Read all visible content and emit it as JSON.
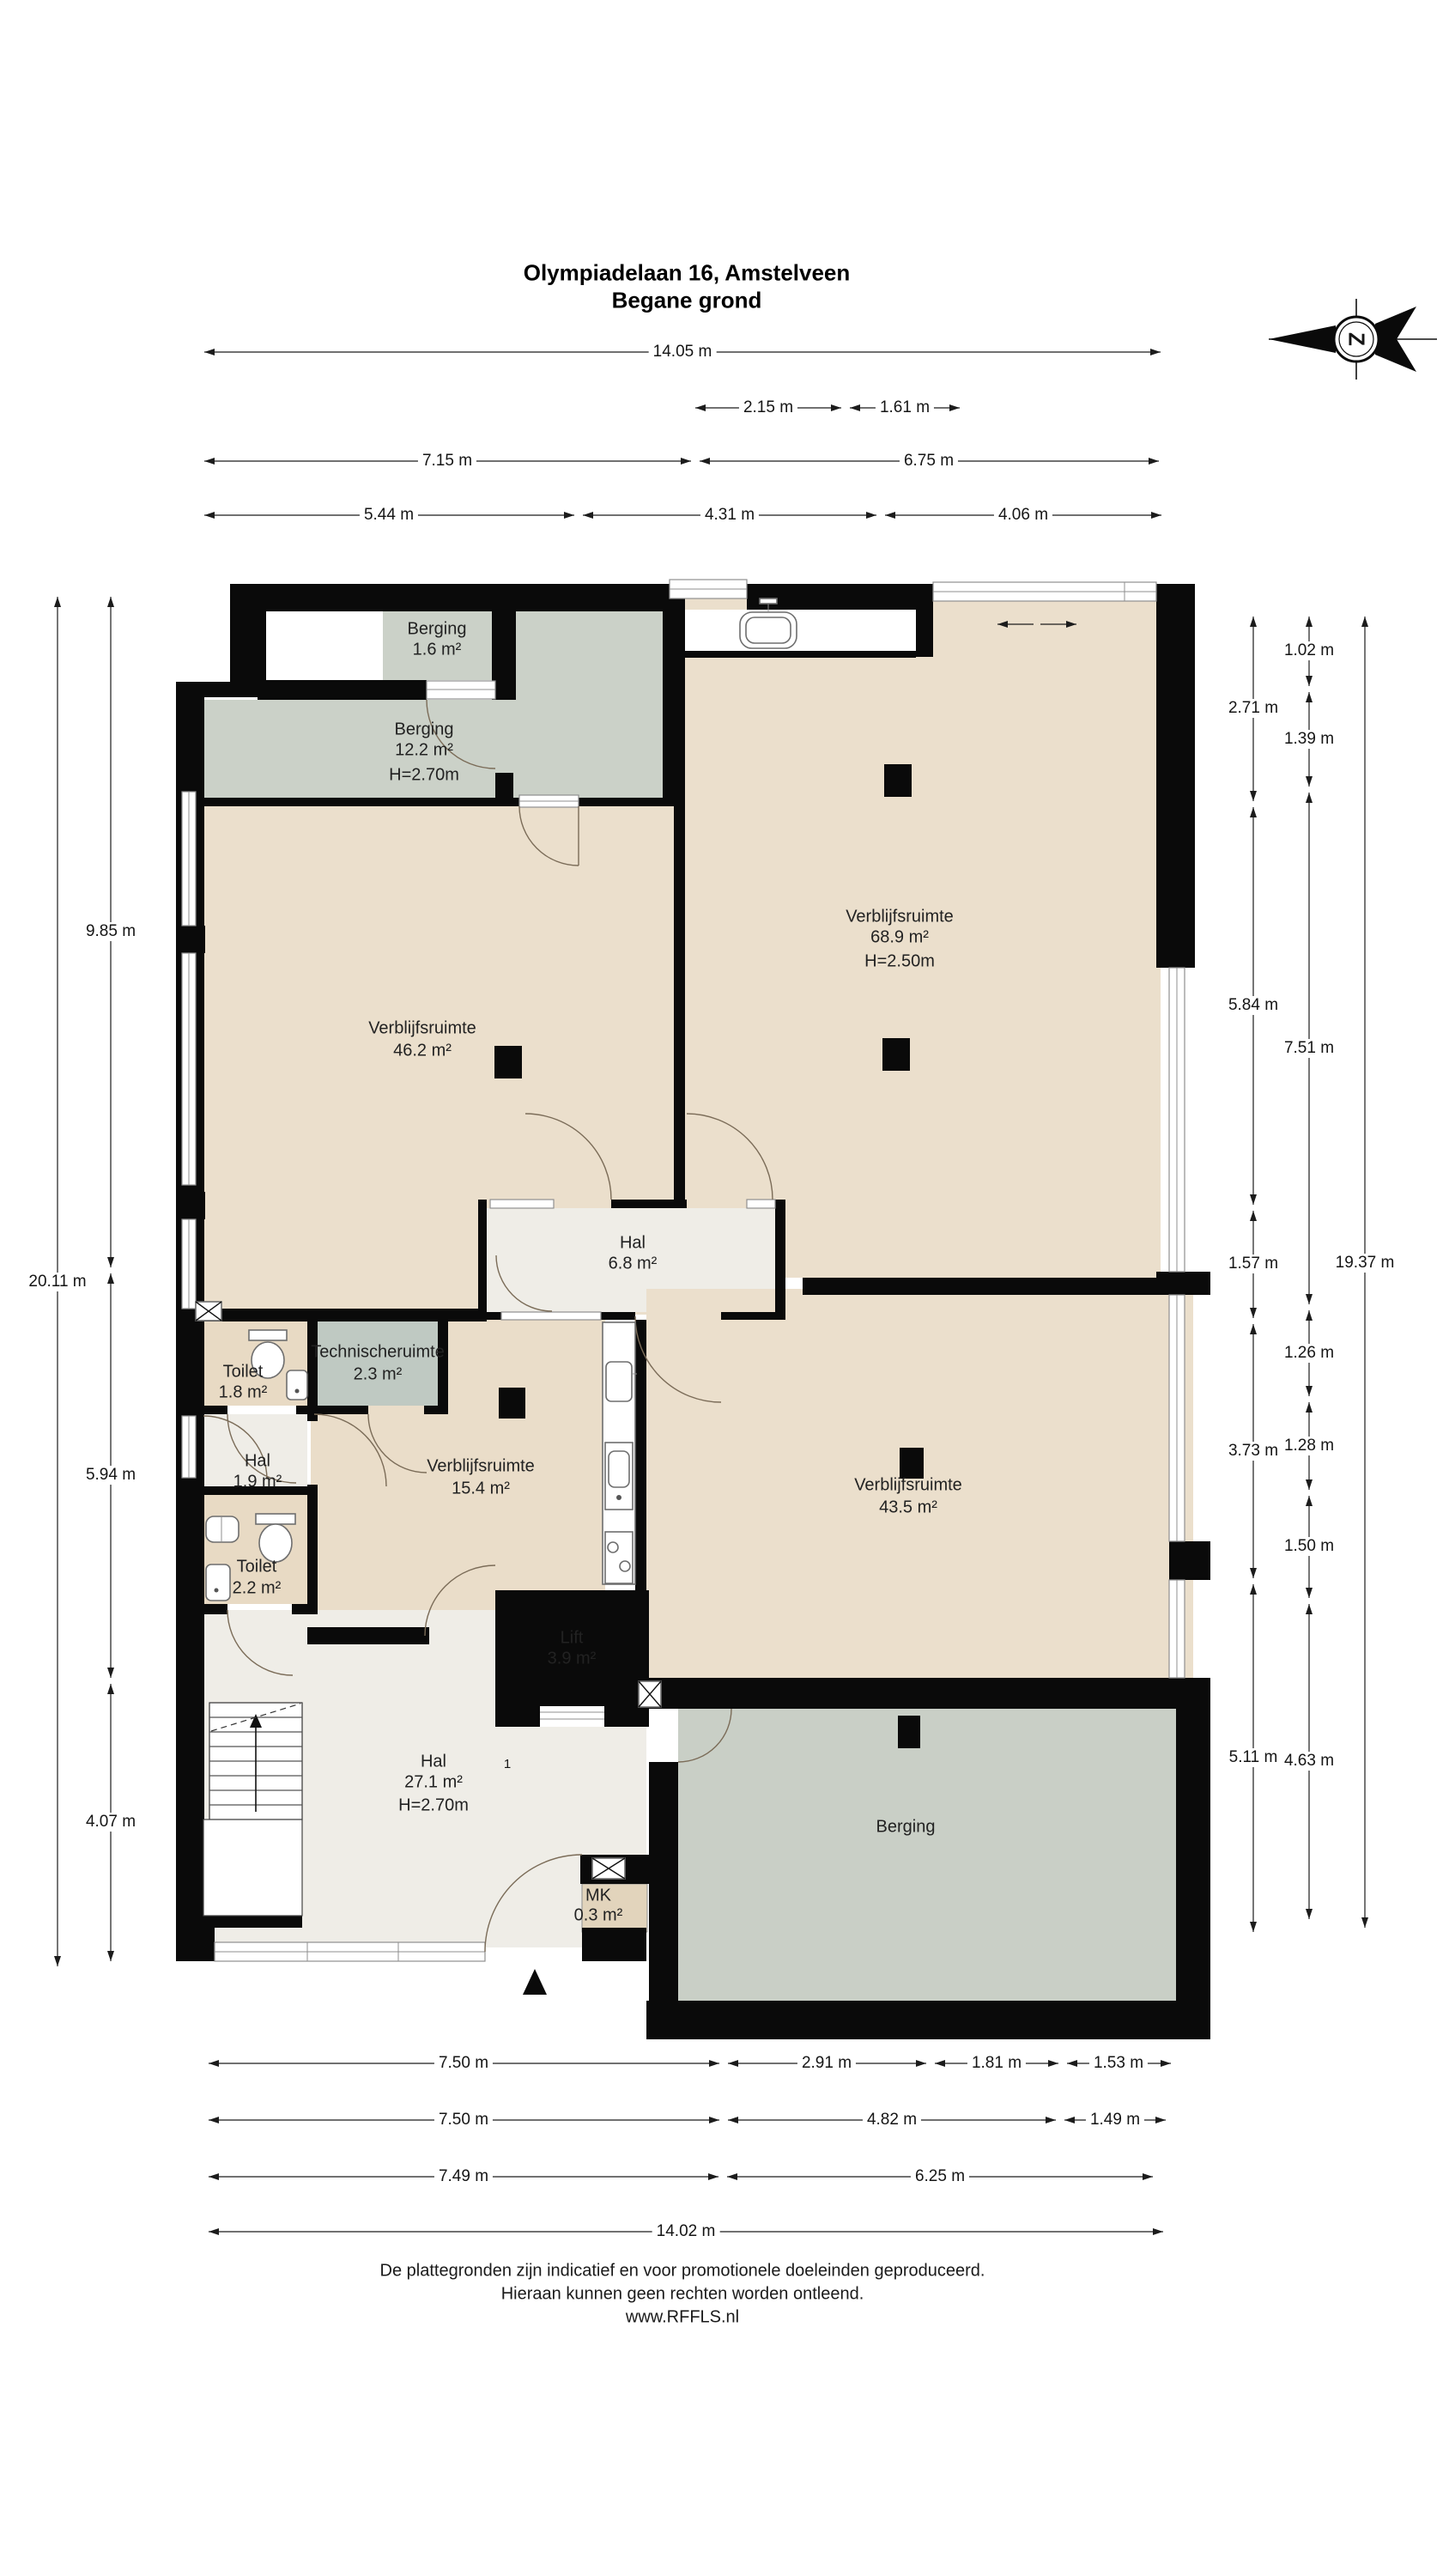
{
  "title": {
    "line1": "Olympiadelaan 16, Amstelveen",
    "line2": "Begane grond"
  },
  "compass": {
    "letter": "Z"
  },
  "rooms": {
    "berging_klein": {
      "name": "Berging",
      "area": "1.6 m²"
    },
    "berging_groot": {
      "name": "Berging",
      "area": "12.2 m²",
      "height": "H=2.70m"
    },
    "verblijfsruimte_68_9": {
      "name": "Verblijfsruimte",
      "area": "68.9 m²",
      "height": "H=2.50m"
    },
    "verblijfsruimte_46_2": {
      "name": "Verblijfsruimte",
      "area": "46.2 m²"
    },
    "hal_6_8": {
      "name": "Hal",
      "area": "6.8 m²"
    },
    "toilet_1_8": {
      "name": "Toilet",
      "area": "1.8 m²"
    },
    "technische_ruimte": {
      "name": "Technischeruimte",
      "area": "2.3 m²"
    },
    "hal_1_9": {
      "name": "Hal",
      "area": "1.9 m²"
    },
    "verblijfsruimte_15_4": {
      "name": "Verblijfsruimte",
      "area": "15.4 m²"
    },
    "verblijfsruimte_43_5": {
      "name": "Verblijfsruimte",
      "area": "43.5 m²"
    },
    "toilet_2_2": {
      "name": "Toilet",
      "area": "2.2 m²"
    },
    "lift": {
      "name": "Lift",
      "area": "3.9 m²"
    },
    "hal_27_1": {
      "name": "Hal",
      "area": "27.1 m²",
      "height": "H=2.70m"
    },
    "meterkast": {
      "name": "MK",
      "area": "0.3 m²"
    },
    "berging_buiten": {
      "name": "Berging"
    }
  },
  "annotations": {
    "lift_door": "1"
  },
  "dimensions": {
    "top": [
      [
        "14.05 m"
      ],
      [
        "2.15 m",
        "1.61 m"
      ],
      [
        "7.15 m",
        "6.75 m"
      ],
      [
        "5.44 m",
        "4.31 m",
        "4.06 m"
      ]
    ],
    "bottom": [
      [
        "7.50 m",
        "2.91 m",
        "1.81 m",
        "1.53 m"
      ],
      [
        "7.50 m",
        "4.82 m",
        "1.49 m"
      ],
      [
        "7.49 m",
        "6.25 m"
      ],
      [
        "14.02 m"
      ]
    ],
    "left_inner": [
      "9.85 m",
      "5.94 m",
      "4.07 m"
    ],
    "left_outer": [
      "20.11 m"
    ],
    "right_inner": [
      "2.71 m",
      "5.84 m",
      "1.57 m",
      "3.73 m",
      "5.11 m"
    ],
    "right_middle": [
      "1.02 m",
      "1.39 m",
      "7.51 m",
      "1.26 m",
      "1.28 m",
      "1.50 m",
      "4.63 m"
    ],
    "right_outer": [
      "19.37 m"
    ]
  },
  "colors": {
    "room_beige": "#EBDFCC",
    "room_tan": "#E8DAC4",
    "berging_gray": "#CBD1C8",
    "tech_gray": "#BFC9C2",
    "hal_light": "#EFEDE7",
    "wall_black": "#0a0a0a"
  },
  "footer": {
    "line1": "De plattegronden zijn indicatief en voor promotionele doeleinden geproduceerd.",
    "line2": "Hieraan kunnen geen rechten worden ontleend.",
    "line3": "www.RFFLS.nl"
  }
}
